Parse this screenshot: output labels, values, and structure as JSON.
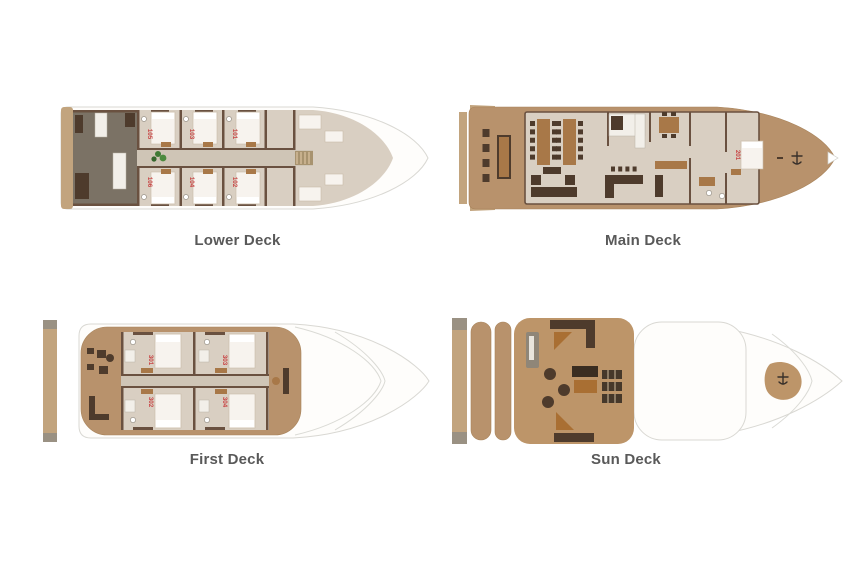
{
  "page": {
    "type": "yacht-deck-plan",
    "background": "#ffffff"
  },
  "decks": [
    {
      "id": "lower-deck",
      "label": "Lower Deck",
      "cabins": [
        "105",
        "103",
        "101",
        "106",
        "104",
        "102"
      ]
    },
    {
      "id": "main-deck",
      "label": "Main Deck",
      "cabins": [
        "201"
      ]
    },
    {
      "id": "first-deck",
      "label": "First Deck",
      "cabins": [
        "301",
        "303",
        "302",
        "304"
      ]
    },
    {
      "id": "sun-deck",
      "label": "Sun Deck",
      "cabins": []
    }
  ],
  "colors": {
    "deck_tan": "#b8926c",
    "platform_tan": "#c2a47e",
    "interior_floor": "#d9cfc2",
    "corridor": "#cfc5b6",
    "wall_brown": "#6a5140",
    "furniture_dark": "#4e3b2c",
    "wood_brown": "#a87848",
    "crew_area": "#7b7265",
    "hull_white": "#fefdfb",
    "hull_outline": "#d9d8d3",
    "cabin_number_red": "#c84444",
    "label_text": "#595959",
    "plant_green": "#3f7a35",
    "accent_orange": "#a96f33"
  }
}
